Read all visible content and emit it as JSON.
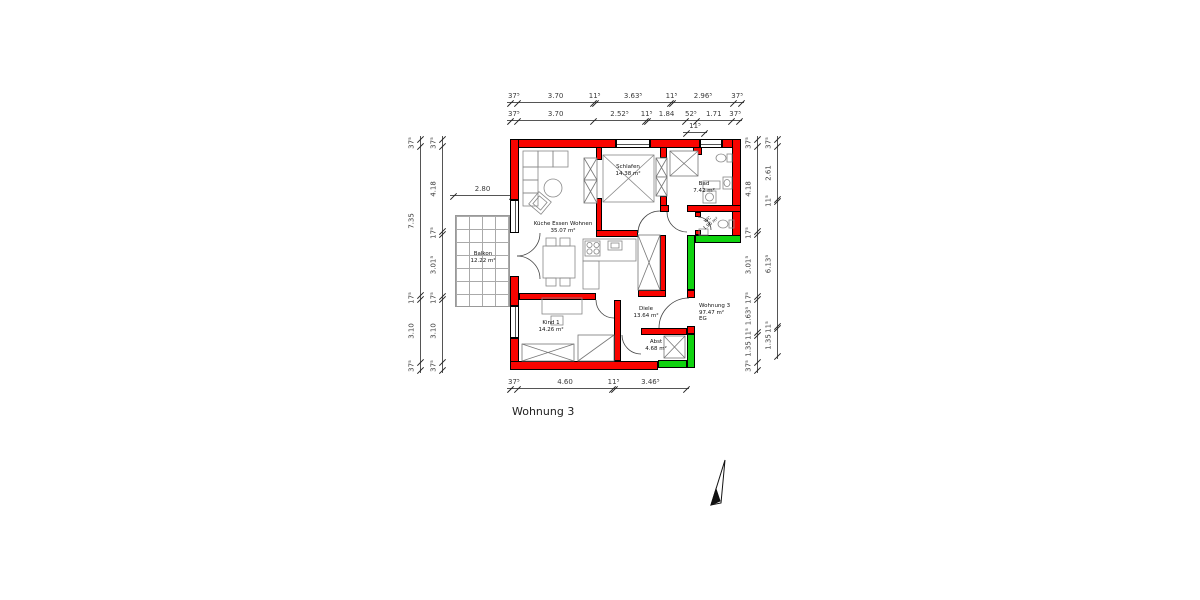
{
  "title": "Wohnung 3",
  "colors": {
    "wall_red": "#f90400",
    "wall_green": "#0fd30f"
  },
  "rooms": {
    "kueche": {
      "name": "Küche Essen Wohnen",
      "area": "35.07 m²"
    },
    "schlafen": {
      "name": "Schlafen",
      "area": "14.38 m²"
    },
    "bad": {
      "name": "Bad",
      "area": "7.42 m²"
    },
    "wc": {
      "name": "WC",
      "area": "1.96 m²"
    },
    "diele": {
      "name": "Diele",
      "area": "13.64 m²"
    },
    "kind": {
      "name": "Kind 1",
      "area": "14.26 m²"
    },
    "abst": {
      "name": "Abst",
      "area": "4.68 m²"
    },
    "balkon": {
      "name": "Balkon",
      "area": "12.22 m²"
    }
  },
  "apartment_label": {
    "name": "Wohnung 3",
    "area": "97.47 m²",
    "floor": "EG"
  },
  "icons": {
    "north_arrow": "north-arrow"
  },
  "dimensions": {
    "top_row_1": {
      "labels": [
        "37⁵",
        "3.70",
        "11⁵",
        "3.63⁵",
        "11⁵",
        "2.96⁵",
        "37⁵"
      ],
      "values": [
        0.375,
        3.7,
        0.115,
        3.635,
        0.115,
        2.965,
        0.375
      ]
    },
    "top_row_2": {
      "labels": [
        "37⁵",
        "3.70",
        "2.52⁵",
        "11⁵",
        "1.84",
        "52⁵",
        "1.71",
        "37⁵"
      ],
      "values": [
        0.375,
        3.7,
        2.525,
        0.115,
        1.84,
        0.525,
        1.71,
        0.375
      ]
    },
    "top_step": {
      "labels": [
        "11⁵"
      ],
      "values": [
        0.115
      ]
    },
    "bottom_row": {
      "labels": [
        "37⁵",
        "4.60",
        "11⁵",
        "3.46⁵"
      ],
      "values": [
        0.375,
        4.6,
        0.115,
        3.465
      ]
    },
    "left_outer": {
      "labels": [
        "37⁵",
        "7.35",
        "17⁵",
        "3.10",
        "37⁵"
      ],
      "values": [
        0.375,
        7.35,
        0.175,
        3.1,
        0.375
      ]
    },
    "left_inner": {
      "labels": [
        "37⁵",
        "4.18",
        "17⁵",
        "3.01⁵",
        "17⁵",
        "3.10",
        "37⁵"
      ],
      "values": [
        0.375,
        4.18,
        0.175,
        3.015,
        0.175,
        3.1,
        0.375
      ]
    },
    "right_inner": {
      "labels": [
        "37⁵",
        "4.18",
        "17⁵",
        "3.01⁵",
        "17⁵",
        "1.63⁵",
        "11⁵",
        "1.35",
        "37⁵"
      ],
      "values": [
        0.375,
        4.18,
        0.175,
        3.015,
        0.175,
        1.635,
        0.115,
        1.35,
        0.375
      ]
    },
    "right_outer": {
      "labels": [
        "37⁵",
        "2.61",
        "11⁵",
        "6.13⁵",
        "11⁵",
        "1.35"
      ],
      "values": [
        0.375,
        2.61,
        0.115,
        6.135,
        0.115,
        1.35
      ]
    },
    "balkon_width": {
      "labels": [
        "2.80"
      ],
      "values": [
        2.8
      ]
    }
  }
}
